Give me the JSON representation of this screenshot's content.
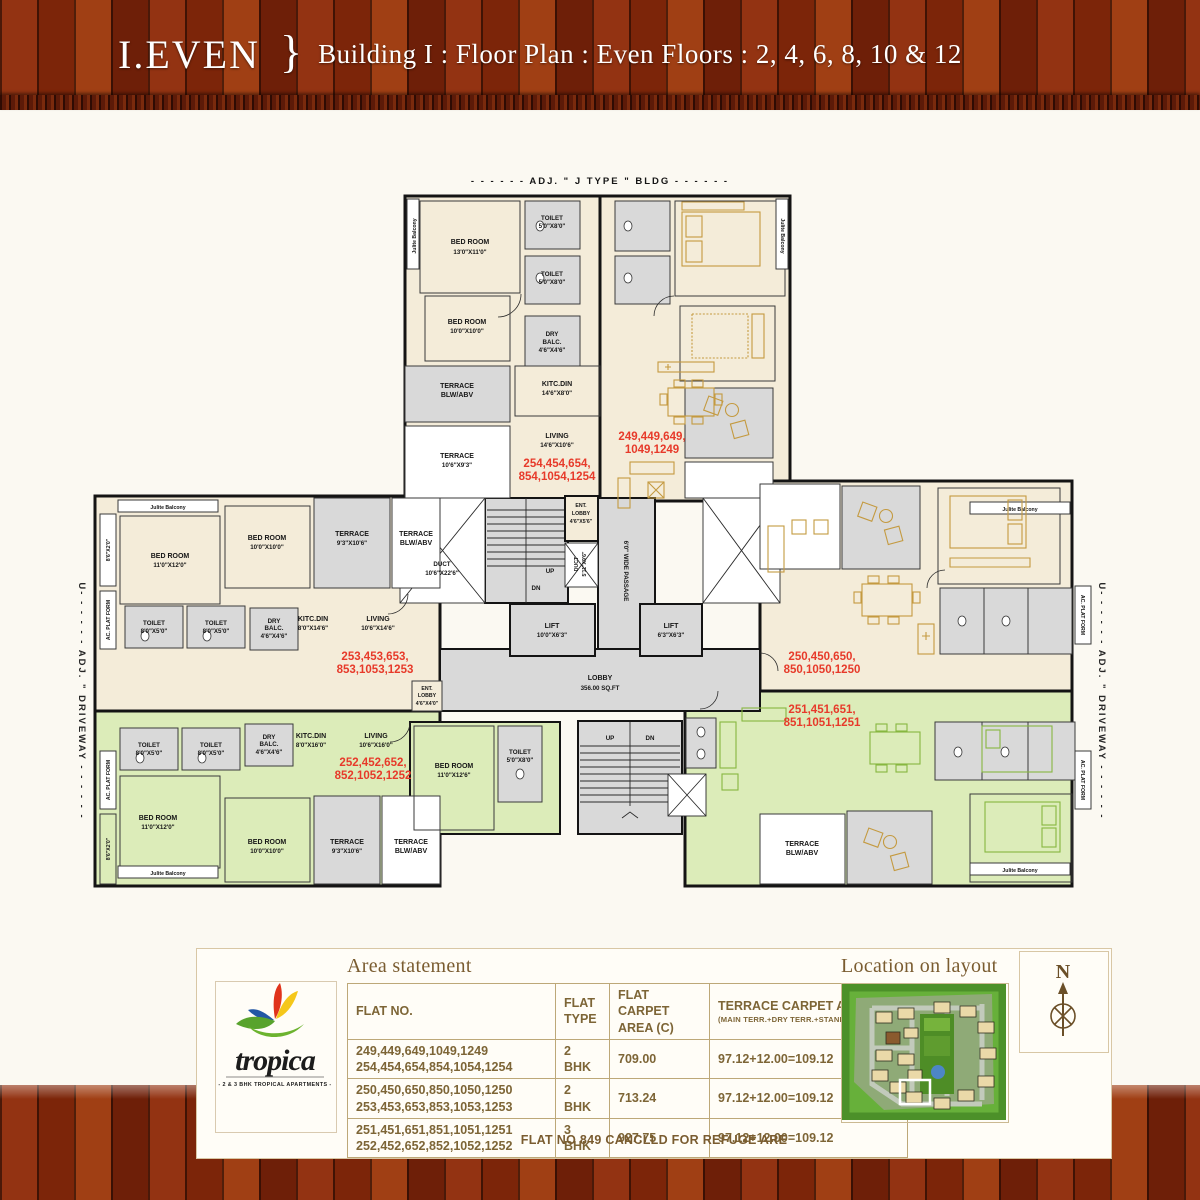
{
  "header": {
    "code": "I.EVEN",
    "brace": "}",
    "title": "Building I : Floor Plan : Even Floors : 2, 4, 6, 8, 10 & 12"
  },
  "plan": {
    "adj_bldg": "- - - - - -   ADJ. \" J TYPE \" BLDG   - - - - - -",
    "driveway": "U- - - - - -   ADJ. \" DRIVEWAY   - - - - - -",
    "julite": "Julite Balcony",
    "ac_platform": "AC. PLAT FORM",
    "strip_8x2": "8'6\"X2'0\"",
    "rooms": {
      "bed": "BED ROOM",
      "toilet": "TOILET",
      "dry1": "DRY",
      "dry2": "BALC.",
      "kitc": "KITC.DIN",
      "living": "LIVING",
      "terrace": "TERRACE",
      "blw": "BLW/ABV",
      "lift": "LIFT",
      "duct": "DUCT",
      "lobby": "LOBBY",
      "lobby_area": "356.00 SQ.FT",
      "ent": "ENT.",
      "ent2": "LOBBY",
      "passage": "6'0\" WIDE PASSAGE",
      "up": "UP",
      "dn": "DN"
    },
    "dims": {
      "d13x11": "13'0\"X11'0\"",
      "d5x8": "5'0\"X8'0\"",
      "d10x10": "10'0\"X10'0\"",
      "d4x4": "4'6\"X4'6\"",
      "d14x8": "14'6\"X8'0\"",
      "d10x9": "10'6\"X9'3\"",
      "d14x10": "14'6\"X10'6\"",
      "d11x12": "11'0\"X12'0\"",
      "d9x10": "9'3\"X10'6\"",
      "d8x5": "8'0\"X5'0\"",
      "d8x14": "8'0\"X14'6\"",
      "d10x14": "10'6\"X14'6\"",
      "d8x16": "8'0\"X16'0\"",
      "d10x16": "10'6\"X16'0\"",
      "d11x126": "11'0\"X12'6\"",
      "d10x22": "10'6\"X22'6\"",
      "d10x6": "10'0\"X6'3\"",
      "d6x6": "6'3\"X6'3\"",
      "d4x5": "4'6\"X5'6\"",
      "d4x40": "4'6\"X4'0\"",
      "d5x9": "5'11\"X9'6\""
    },
    "flats": {
      "f254": [
        "254,454,654,",
        "854,1054,1254"
      ],
      "f249": [
        "249,449,649,",
        "1049,1249"
      ],
      "f253": [
        "253,453,653,",
        "853,1053,1253"
      ],
      "f250": [
        "250,450,650,",
        "850,1050,1250"
      ],
      "f252": [
        "252,452,652,",
        "852,1052,1252"
      ],
      "f251": [
        "251,451,651,",
        "851,1051,1251"
      ]
    }
  },
  "logo": {
    "name": "tropica",
    "tagline": "- 2 & 3 BHK    TROPICAL APARTMENTS -"
  },
  "area_statement": {
    "heading": "Area statement",
    "columns": {
      "c1": "FLAT NO.",
      "c2": "FLAT TYPE",
      "c3": "FLAT CARPET AREA (C)",
      "c4": "TERRACE CARPET AREA (T)",
      "c4sub": "(MAIN TERR.+DRY TERR.+STAND IN WINDOW)"
    },
    "rows": [
      {
        "flats": [
          "249,449,649,1049,1249",
          "254,454,654,854,1054,1254"
        ],
        "type": "2 BHK",
        "carpet": "709.00",
        "terrace": "97.12+12.00=109.12"
      },
      {
        "flats": [
          "250,450,650,850,1050,1250",
          "253,453,653,853,1053,1253"
        ],
        "type": "2 BHK",
        "carpet": "713.24",
        "terrace": "97.12+12.00=109.12"
      },
      {
        "flats": [
          "251,451,651,851,1051,1251",
          "252,452,652,852,1052,1252"
        ],
        "type": "3 BHK",
        "carpet": "927.75",
        "terrace": "97.12+12.00=109.12"
      }
    ],
    "note": "FLAT NO 849 CANCLLD FOR REFUGE ARE"
  },
  "location": {
    "heading": "Location on layout",
    "compass": "N"
  }
}
